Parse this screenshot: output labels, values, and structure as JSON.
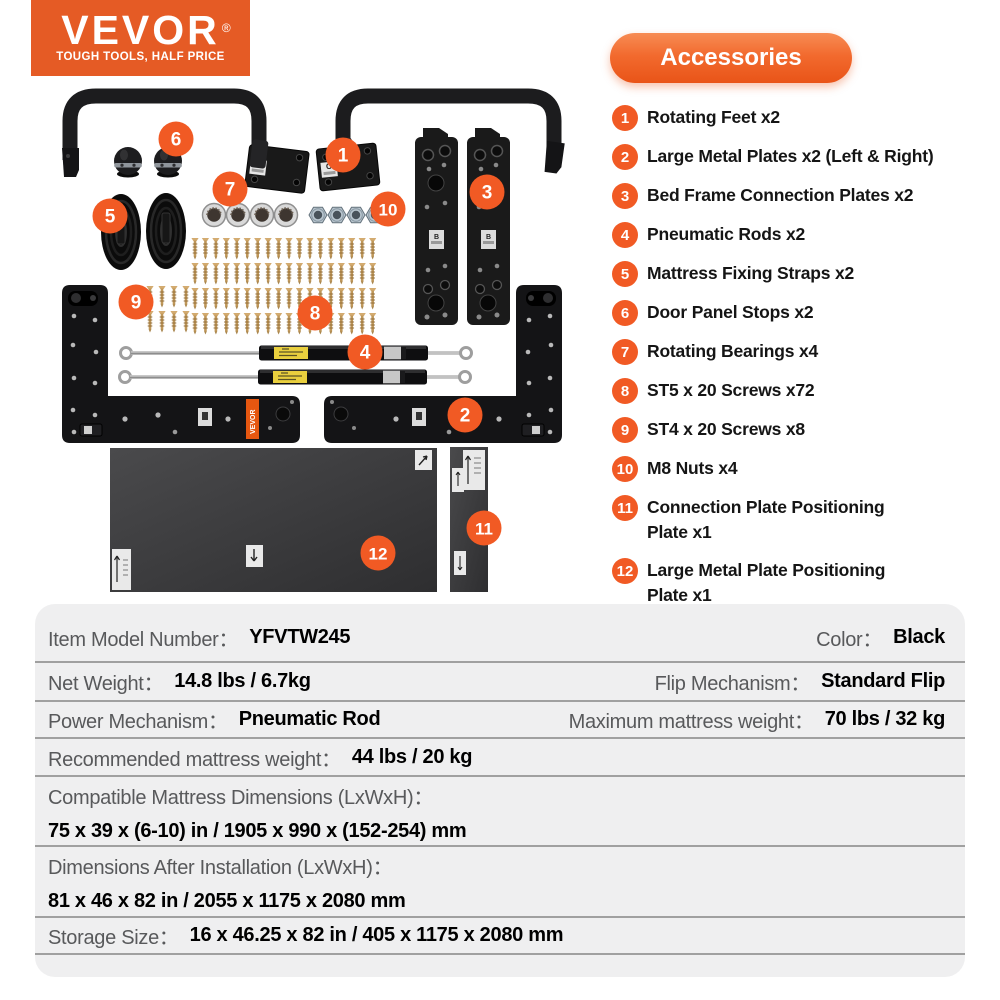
{
  "brand": {
    "name": "VEVOR",
    "registered": "®",
    "tagline": "TOUGH TOOLS, HALF PRICE"
  },
  "accessories": {
    "title": "Accessories",
    "items": [
      {
        "number": "1",
        "lines": [
          "Rotating Feet x2"
        ]
      },
      {
        "number": "2",
        "lines": [
          "Large Metal Plates x2 (Left & Right)"
        ]
      },
      {
        "number": "3",
        "lines": [
          "Bed Frame Connection Plates x2"
        ]
      },
      {
        "number": "4",
        "lines": [
          "Pneumatic Rods x2"
        ]
      },
      {
        "number": "5",
        "lines": [
          "Mattress Fixing Straps x2"
        ]
      },
      {
        "number": "6",
        "lines": [
          "Door Panel Stops x2"
        ]
      },
      {
        "number": "7",
        "lines": [
          "Rotating Bearings x4"
        ]
      },
      {
        "number": "8",
        "lines": [
          "ST5 x 20 Screws x72"
        ]
      },
      {
        "number": "9",
        "lines": [
          "ST4 x 20 Screws x8"
        ]
      },
      {
        "number": "10",
        "lines": [
          "M8 Nuts x4"
        ]
      },
      {
        "number": "11",
        "lines": [
          "Connection Plate Positioning",
          "Plate x1"
        ]
      },
      {
        "number": "12",
        "lines": [
          "Large Metal Plate Positioning",
          "Plate x1"
        ]
      }
    ]
  },
  "diagram": {
    "c_plate_label": "C",
    "b_plate_label": "B",
    "vevor_plate_label": "VEVOR"
  },
  "specs": {
    "rows": [
      {
        "cells": [
          {
            "label": "Item Model Number：",
            "value": "YFVTW245"
          },
          {
            "label": "Color：",
            "value": "Black"
          }
        ]
      },
      {
        "cells": [
          {
            "label": "Net Weight：",
            "value": "14.8 lbs / 6.7kg"
          },
          {
            "label": "Flip Mechanism：",
            "value": "Standard Flip"
          }
        ]
      },
      {
        "cells": [
          {
            "label": "Power Mechanism：",
            "value": "Pneumatic Rod"
          },
          {
            "label": "Maximum mattress weight：",
            "value": "70 lbs / 32 kg"
          }
        ]
      },
      {
        "cells": [
          {
            "label": "Recommended mattress weight：",
            "value": "44 lbs / 20 kg"
          }
        ]
      },
      {
        "stacked": true,
        "label": "Compatible Mattress Dimensions (LxWxH)：",
        "value": "75 x 39 x (6-10) in / 1905 x 990 x (152-254) mm"
      },
      {
        "stacked": true,
        "label": "Dimensions After Installation (LxWxH)：",
        "value": "81 x 46 x 82 in / 2055 x 1175 x 2080 mm"
      },
      {
        "cells": [
          {
            "label": "Storage Size：",
            "value": "16 x 46.25 x 82 in / 405 x 1175 x 2080 mm"
          }
        ]
      }
    ]
  },
  "colors": {
    "accent": "#f15a24",
    "logo_bg": "#e55b25",
    "pill_top": "#f78c54",
    "pill_bottom": "#e95418",
    "table_bg": "#efeff0",
    "divider": "#a0a0a0",
    "label_gray": "#58595b"
  }
}
